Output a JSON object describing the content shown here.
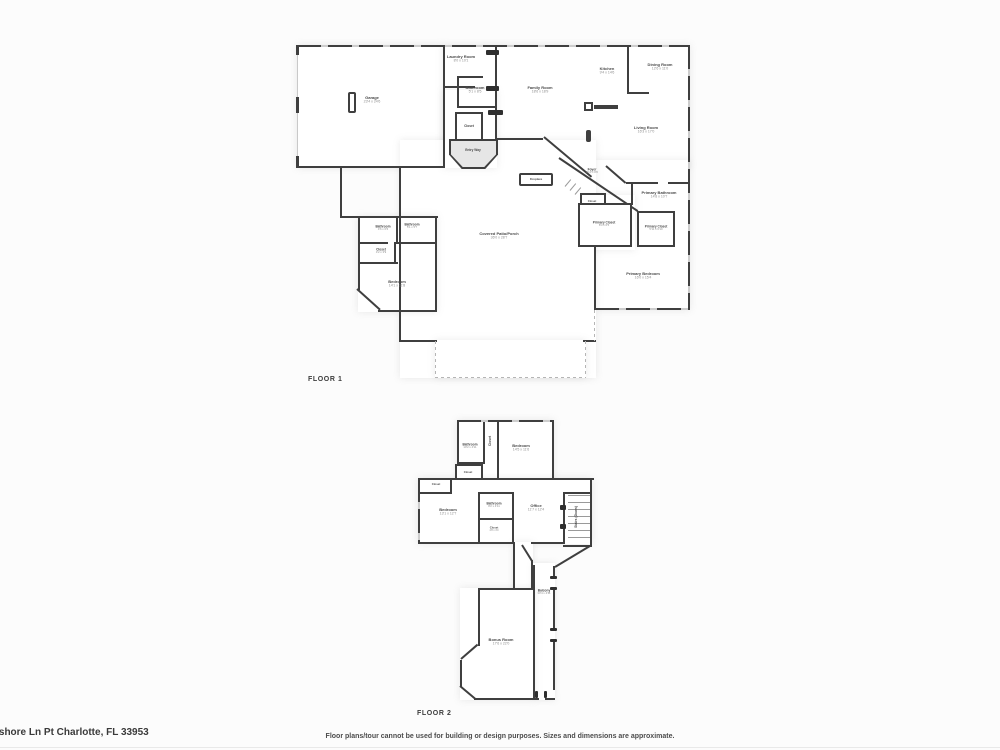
{
  "meta": {
    "address": "rshore Ln Pt Charlotte, FL 33953",
    "disclaimer": "Floor plans/tour cannot be used for building or design purposes. Sizes and dimensions are approximate."
  },
  "floor1": {
    "caption": "FLOOR 1",
    "rooms": {
      "garage": {
        "name": "Garage",
        "dims": "23'4 x 24'6"
      },
      "laundry": {
        "name": "Laundry Room",
        "dims": "8'0 x 10'1"
      },
      "bathroom_top": {
        "name": "Bathroom",
        "dims": "5'1 x 8'5"
      },
      "family": {
        "name": "Family Room",
        "dims": "18'6 x 18'9"
      },
      "kitchen": {
        "name": "Kitchen",
        "dims": "9'4 x 14'6"
      },
      "dining": {
        "name": "Dining Room",
        "dims": "12'6 x 11'0"
      },
      "living": {
        "name": "Living Room",
        "dims": "16'3 x 17'0"
      },
      "closet_entry": {
        "name": "Closet"
      },
      "entry": {
        "name": "Entry Way"
      },
      "fireplace": {
        "name": "Fireplace"
      },
      "foyer": {
        "name": "Foyer",
        "dims": "7'10 x 8'0"
      },
      "closet_foyer": {
        "name": "Closet"
      },
      "primary_bathroom": {
        "name": "Primary Bathroom",
        "dims": "14'8 x 10'7"
      },
      "primary_closet_a": {
        "name": "Primary Closet",
        "dims": "8'3 x 6'5"
      },
      "primary_closet_b": {
        "name": "Primary Closet",
        "dims": "5'11 x 6'10"
      },
      "primary_bedroom": {
        "name": "Primary Bedroom",
        "dims": "16'0 x 15'4"
      },
      "patio": {
        "name": "Covered Patio/Porch",
        "dims": "36'0 x 28'7"
      },
      "bathroom_a": {
        "name": "Bathroom",
        "dims": "4'6 x 6'6"
      },
      "bathroom_b": {
        "name": "Bathroom",
        "dims": "5'1 x 5'7"
      },
      "closet_a": {
        "name": "Closet",
        "dims": "4'2 x 3'9"
      },
      "bedroom": {
        "name": "Bedroom",
        "dims": "14'1 x 11'8"
      }
    }
  },
  "floor2": {
    "caption": "FLOOR 2",
    "rooms": {
      "bathroom_a": {
        "name": "Bathroom",
        "dims": "10'2 x 4'11"
      },
      "closet_a": {
        "name": "Closet"
      },
      "bedroom_a": {
        "name": "Bedroom",
        "dims": "14'5 x 11'6"
      },
      "closet_b": {
        "name": "Closet"
      },
      "closet_c": {
        "name": "Closet"
      },
      "bedroom_b": {
        "name": "Bedroom",
        "dims": "13'1 x 12'7"
      },
      "bathroom_b": {
        "name": "Bathroom",
        "dims": "8'2 x 4'11"
      },
      "closet_d": {
        "name": "Closet",
        "dims": "4'8 x 4'0"
      },
      "office": {
        "name": "Office",
        "dims": "11'7 x 12'4"
      },
      "stairs": {
        "name": "Stairs (Down)"
      },
      "balcony": {
        "name": "Balcony",
        "dims": "30'4 x 4'11"
      },
      "bonus": {
        "name": "Bonus Room",
        "dims": "17'6 x 22'0"
      }
    }
  }
}
